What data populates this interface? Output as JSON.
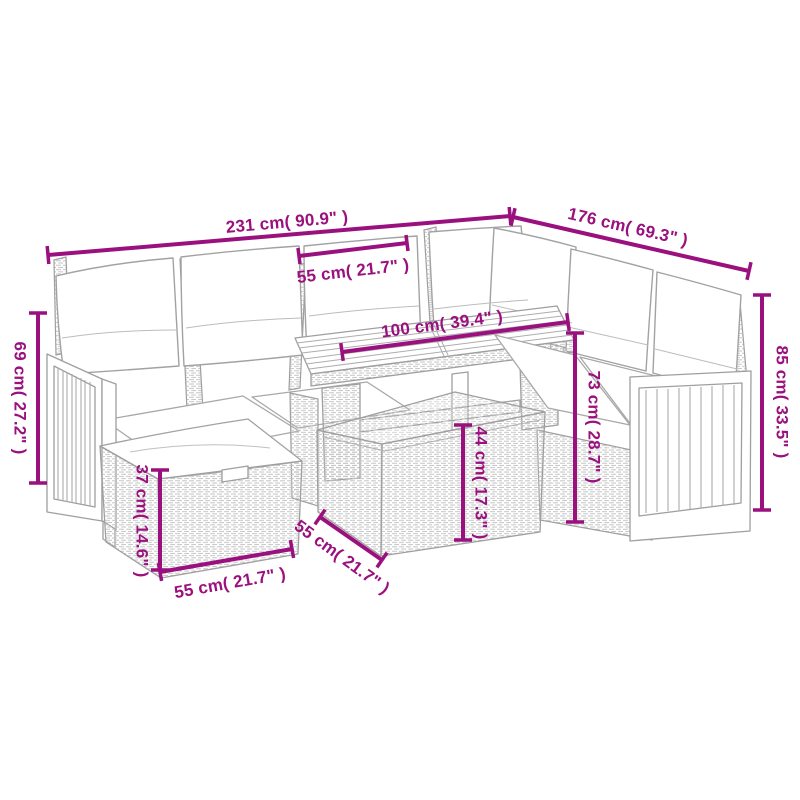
{
  "figure": {
    "kind": "product-dimension-diagram",
    "product": "rattan-garden-lounge-set-with-table-and-ottomans",
    "background_color": "#ffffff",
    "accent_color": "#9a107e",
    "line_art_color": "#a0a0a0"
  },
  "dimensions": {
    "total_width": "231 cm( 90.9\" )",
    "total_depth": "176 cm( 69.3\" )",
    "seat_width": "55 cm( 21.7\" )",
    "table_length": "100 cm( 39.4\" )",
    "left_back_height": "69 cm( 27.2\" )",
    "right_back_height": "85 cm( 33.5\" )",
    "table_height": "73 cm( 28.7\" )",
    "front_box_height": "44 cm( 17.3\" )",
    "ottoman_height": "37 cm( 14.6\" )",
    "ottoman_width": "55 cm( 21.7\" )",
    "table_depth": "55 cm( 21.7\" )"
  }
}
